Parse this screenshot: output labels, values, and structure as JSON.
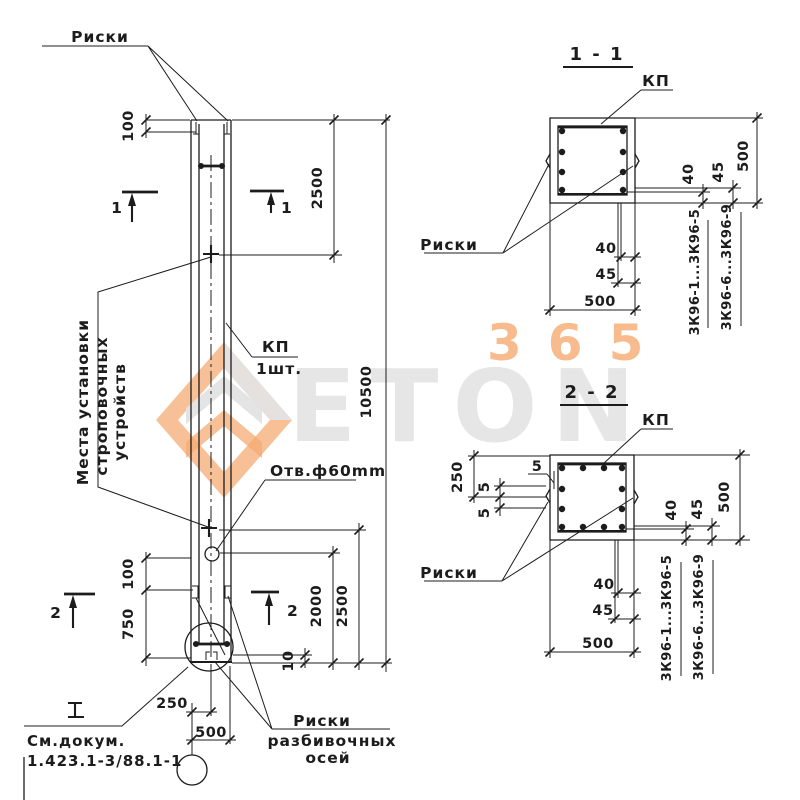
{
  "watermark": {
    "number": "365",
    "brand": "ETON",
    "orange": "#F4A263",
    "gray": "#E4E4E4"
  },
  "labels": {
    "risk": "Риски",
    "strop1": "Места установки",
    "strop2": "строповочных",
    "strop3": "устройств",
    "kp": "КП",
    "kp_qty": "1шт.",
    "hole": "Отв.ф60mm",
    "doc1": "См.докум.",
    "doc2": "1.423.1-3/88.1-1",
    "axes1": "Риски",
    "axes2": "разбивочных",
    "axes3": "осей",
    "cut1": "1",
    "cut2": "2"
  },
  "dims": {
    "d5": "5",
    "d10": "10",
    "d40": "40",
    "d45": "45",
    "d100": "100",
    "d250": "250",
    "d500": "500",
    "d750": "750",
    "d2000": "2000",
    "d2500": "2500",
    "d10500": "10500"
  },
  "sections": {
    "s11": "1 - 1",
    "s22": "2 - 2",
    "series_a": "3К96-1...3К96-5",
    "series_b": "3К96-6...3К96-9"
  }
}
